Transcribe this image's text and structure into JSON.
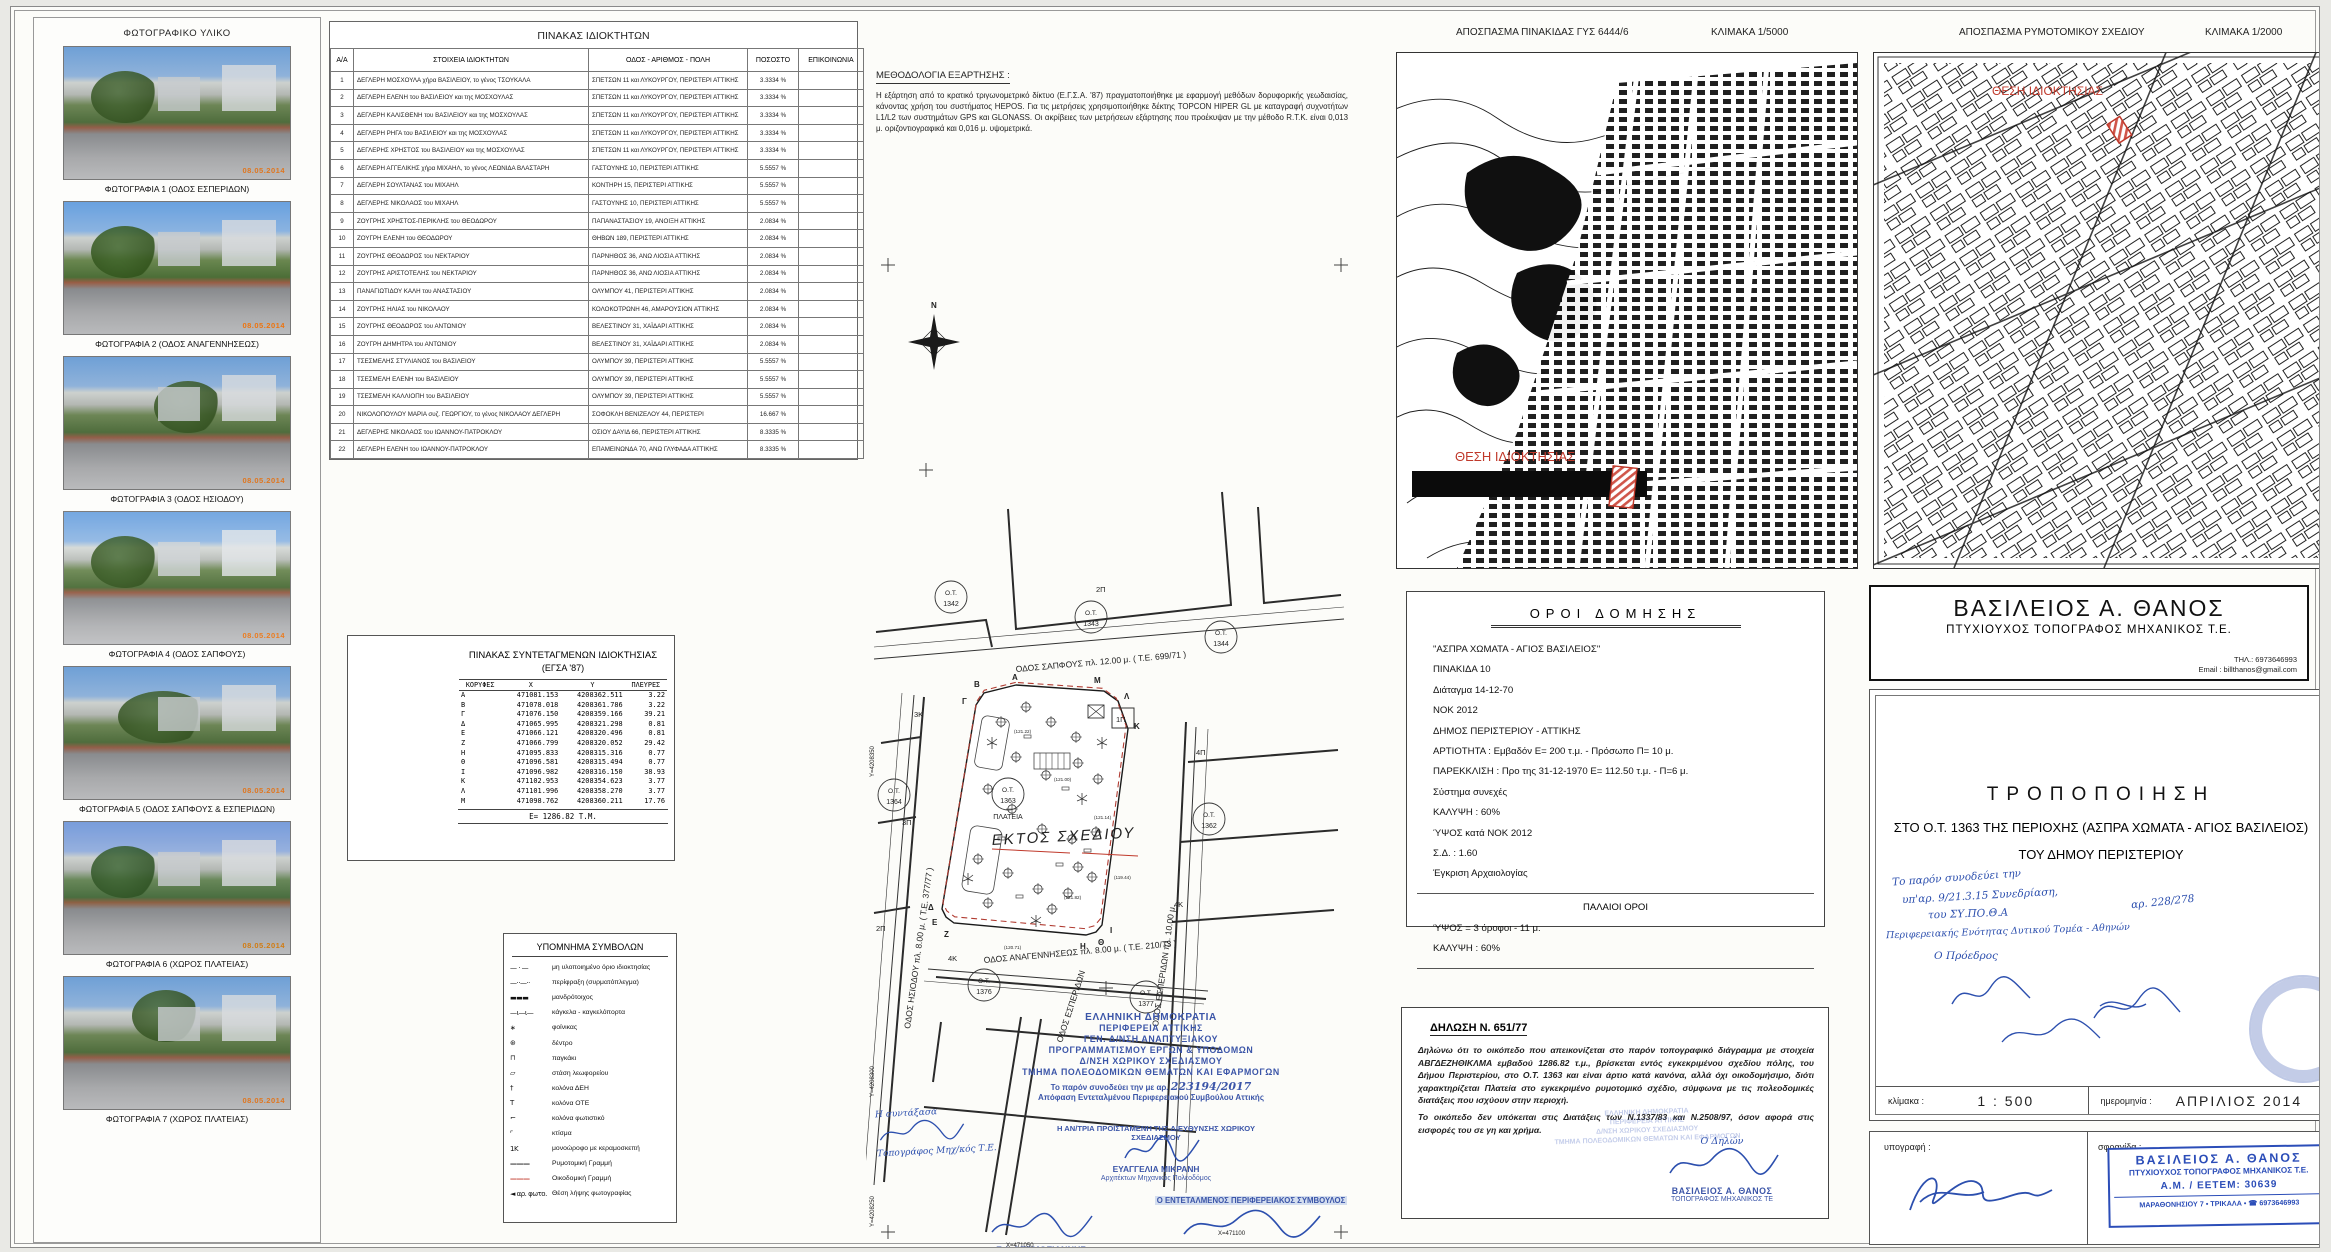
{
  "photos": {
    "title": "ΦΩΤΟΓΡΑΦΙΚΟ ΥΛΙΚΟ",
    "items": [
      {
        "caption": "ΦΩΤΟΓΡΑΦΙΑ 1 (ΟΔΟΣ ΕΣΠΕΡΙΔΩΝ)",
        "date": "08.05.2014"
      },
      {
        "caption": "ΦΩΤΟΓΡΑΦΙΑ 2 (ΟΔΟΣ ΑΝΑΓΕΝΝΗΣΕΩΣ)",
        "date": "08.05.2014"
      },
      {
        "caption": "ΦΩΤΟΓΡΑΦΙΑ 3 (ΟΔΟΣ ΗΣΙΟΔΟΥ)",
        "date": "08.05.2014"
      },
      {
        "caption": "ΦΩΤΟΓΡΑΦΙΑ 4 (ΟΔΟΣ ΣΑΠΦΟΥΣ)",
        "date": "08.05.2014"
      },
      {
        "caption": "ΦΩΤΟΓΡΑΦΙΑ 5 (ΟΔΟΣ ΣΑΠΦΟΥΣ & ΕΣΠΕΡΙΔΩΝ)",
        "date": "08.05.2014"
      },
      {
        "caption": "ΦΩΤΟΓΡΑΦΙΑ 6 (ΧΩΡΟΣ ΠΛΑΤΕΙΑΣ)",
        "date": "08.05.2014"
      },
      {
        "caption": "ΦΩΤΟΓΡΑΦΙΑ 7 (ΧΩΡΟΣ ΠΛΑΤΕΙΑΣ)",
        "date": "08.05.2014"
      }
    ]
  },
  "owners_table": {
    "title": "ΠΙΝΑΚΑΣ ΙΔΙΟΚΤΗΤΩΝ",
    "columns": [
      "Α/Α",
      "ΣΤΟΙΧΕΙΑ ΙΔΙΟΚΤΗΤΩΝ",
      "ΟΔΟΣ - ΑΡΙΘΜΟΣ - ΠΟΛΗ",
      "ΠΟΣΟΣΤΟ",
      "ΕΠΙΚΟΙΝΩΝΙΑ"
    ],
    "rows": [
      {
        "n": "1",
        "name": "ΔΕΓΛΕΡΗ ΜΟΣΧΟΥΛΑ χήρα ΒΑΣΙΛΕΙΟΥ, το γένος ΤΣΟΥΚΑΛΑ",
        "addr": "ΣΠΕΤΣΩΝ 11 και ΛΥΚΟΥΡΓΟΥ, ΠΕΡΙΣΤΕΡΙ ΑΤΤΙΚΗΣ",
        "pct": "3.3334 %",
        "contact": ""
      },
      {
        "n": "2",
        "name": "ΔΕΓΛΕΡΗ ΕΛΕΝΗ του ΒΑΣΙΛΕΙΟΥ και της ΜΟΣΧΟΥΛΑΣ",
        "addr": "ΣΠΕΤΣΩΝ 11 και ΛΥΚΟΥΡΓΟΥ, ΠΕΡΙΣΤΕΡΙ ΑΤΤΙΚΗΣ",
        "pct": "3.3334 %",
        "contact": ""
      },
      {
        "n": "3",
        "name": "ΔΕΓΛΕΡΗ ΚΑΛΙΣΘΕΝΗ του ΒΑΣΙΛΕΙΟΥ και της ΜΟΣΧΟΥΛΑΣ",
        "addr": "ΣΠΕΤΣΩΝ 11 και ΛΥΚΟΥΡΓΟΥ, ΠΕΡΙΣΤΕΡΙ ΑΤΤΙΚΗΣ",
        "pct": "3.3334 %",
        "contact": ""
      },
      {
        "n": "4",
        "name": "ΔΕΓΛΕΡΗ ΡΗΓΑ του ΒΑΣΙΛΕΙΟΥ και της ΜΟΣΧΟΥΛΑΣ",
        "addr": "ΣΠΕΤΣΩΝ 11 και ΛΥΚΟΥΡΓΟΥ, ΠΕΡΙΣΤΕΡΙ ΑΤΤΙΚΗΣ",
        "pct": "3.3334 %",
        "contact": ""
      },
      {
        "n": "5",
        "name": "ΔΕΓΛΕΡΗΣ ΧΡΗΣΤΟΣ του ΒΑΣΙΛΕΙΟΥ και της ΜΟΣΧΟΥΛΑΣ",
        "addr": "ΣΠΕΤΣΩΝ 11 και ΛΥΚΟΥΡΓΟΥ, ΠΕΡΙΣΤΕΡΙ ΑΤΤΙΚΗΣ",
        "pct": "3.3334 %",
        "contact": ""
      },
      {
        "n": "6",
        "name": "ΔΕΓΛΕΡΗ ΑΓΓΕΛΙΚΗΣ χήρα ΜΙΧΑΗΛ, το γένος ΛΕΩΝΙΔΑ ΒΛΑΣΤΑΡΗ",
        "addr": "ΓΑΣΤΟΥΝΗΣ 10, ΠΕΡΙΣΤΕΡΙ ΑΤΤΙΚΗΣ",
        "pct": "5.5557 %",
        "contact": ""
      },
      {
        "n": "7",
        "name": "ΔΕΓΛΕΡΗ ΣΟΥΛΤΑΝΑΣ του ΜΙΧΑΗΛ",
        "addr": "ΚΟΝΤΗΡΗ 15, ΠΕΡΙΣΤΕΡΙ ΑΤΤΙΚΗΣ",
        "pct": "5.5557 %",
        "contact": ""
      },
      {
        "n": "8",
        "name": "ΔΕΓΛΕΡΗΣ ΝΙΚΟΛΑΟΣ του ΜΙΧΑΗΛ",
        "addr": "ΓΑΣΤΟΥΝΗΣ 10, ΠΕΡΙΣΤΕΡΙ ΑΤΤΙΚΗΣ",
        "pct": "5.5557 %",
        "contact": ""
      },
      {
        "n": "9",
        "name": "ΖΟΥΓΡΗΣ ΧΡΗΣΤΟΣ-ΠΕΡΙΚΛΗΣ του ΘΕΟΔΩΡΟΥ",
        "addr": "ΠΑΠΑΝΑΣΤΑΣΙΟΥ 19, ΑΝΟΙΞΗ ΑΤΤΙΚΗΣ",
        "pct": "2.0834 %",
        "contact": ""
      },
      {
        "n": "10",
        "name": "ΖΟΥΓΡΗ ΕΛΕΝΗ του ΘΕΟΔΩΡΟΥ",
        "addr": "ΘΗΒΩΝ 189, ΠΕΡΙΣΤΕΡΙ ΑΤΤΙΚΗΣ",
        "pct": "2.0834 %",
        "contact": ""
      },
      {
        "n": "11",
        "name": "ΖΟΥΓΡΗΣ ΘΕΟΔΩΡΟΣ του ΝΕΚΤΑΡΙΟΥ",
        "addr": "ΠΑΡΝΗΘΟΣ 36, ΑΝΩ ΛΙΟΣΙΑ ΑΤΤΙΚΗΣ",
        "pct": "2.0834 %",
        "contact": ""
      },
      {
        "n": "12",
        "name": "ΖΟΥΓΡΗΣ ΑΡΙΣΤΟΤΕΛΗΣ του ΝΕΚΤΑΡΙΟΥ",
        "addr": "ΠΑΡΝΗΘΟΣ 36, ΑΝΩ ΛΙΟΣΙΑ ΑΤΤΙΚΗΣ",
        "pct": "2.0834 %",
        "contact": ""
      },
      {
        "n": "13",
        "name": "ΠΑΝΑΓΙΩΤΙΔΟΥ ΚΑΛΗ του ΑΝΑΣΤΑΣΙΟΥ",
        "addr": "ΟΛΥΜΠΟΥ 41, ΠΕΡΙΣΤΕΡΙ ΑΤΤΙΚΗΣ",
        "pct": "2.0834 %",
        "contact": ""
      },
      {
        "n": "14",
        "name": "ΖΟΥΓΡΗΣ ΗΛΙΑΣ του ΝΙΚΟΛΑΟΥ",
        "addr": "ΚΟΛΟΚΟΤΡΩΝΗ 46, ΑΜΑΡΟΥΣΙΟΝ ΑΤΤΙΚΗΣ",
        "pct": "2.0834 %",
        "contact": ""
      },
      {
        "n": "15",
        "name": "ΖΟΥΓΡΗΣ ΘΕΟΔΩΡΟΣ του ΑΝΤΩΝΙΟΥ",
        "addr": "ΒΕΛΕΣΤΙΝΟΥ 31, ΧΑΪΔΑΡΙ ΑΤΤΙΚΗΣ",
        "pct": "2.0834 %",
        "contact": ""
      },
      {
        "n": "16",
        "name": "ΖΟΥΓΡΗ ΔΗΜΗΤΡΑ του ΑΝΤΩΝΙΟΥ",
        "addr": "ΒΕΛΕΣΤΙΝΟΥ 31, ΧΑΪΔΑΡΙ ΑΤΤΙΚΗΣ",
        "pct": "2.0834 %",
        "contact": ""
      },
      {
        "n": "17",
        "name": "ΤΣΕΣΜΕΛΗΣ ΣΤΥΛΙΑΝΟΣ του ΒΑΣΙΛΕΙΟΥ",
        "addr": "ΟΛΥΜΠΟΥ 39, ΠΕΡΙΣΤΕΡΙ ΑΤΤΙΚΗΣ",
        "pct": "5.5557 %",
        "contact": ""
      },
      {
        "n": "18",
        "name": "ΤΣΕΣΜΕΛΗ ΕΛΕΝΗ του ΒΑΣΙΛΕΙΟΥ",
        "addr": "ΟΛΥΜΠΟΥ 39, ΠΕΡΙΣΤΕΡΙ ΑΤΤΙΚΗΣ",
        "pct": "5.5557 %",
        "contact": ""
      },
      {
        "n": "19",
        "name": "ΤΣΕΣΜΕΛΗ ΚΑΛΛΙΟΠΗ του ΒΑΣΙΛΕΙΟΥ",
        "addr": "ΟΛΥΜΠΟΥ 39, ΠΕΡΙΣΤΕΡΙ ΑΤΤΙΚΗΣ",
        "pct": "5.5557 %",
        "contact": ""
      },
      {
        "n": "20",
        "name": "ΝΙΚΟΛΟΠΟΥΛΟΥ ΜΑΡΙΑ συζ. ΓΕΩΡΓΙΟΥ, το γένος ΝΙΚΟΛΑΟΥ ΔΕΓΛΕΡΗ",
        "addr": "ΣΟΦΟΚΛΗ ΒΕΝΙΖΕΛΟΥ 44, ΠΕΡΙΣΤΕΡΙ",
        "pct": "16.667 %",
        "contact": ""
      },
      {
        "n": "21",
        "name": "ΔΕΓΛΕΡΗΣ ΝΙΚΟΛΑΟΣ του ΙΩΑΝΝΟΥ-ΠΑΤΡΟΚΛΟΥ",
        "addr": "ΟΣΙΟΥ ΔΑΥΙΔ 66, ΠΕΡΙΣΤΕΡΙ ΑΤΤΙΚΗΣ",
        "pct": "8.3335 %",
        "contact": ""
      },
      {
        "n": "22",
        "name": "ΔΕΓΛΕΡΗ ΕΛΕΝΗ του ΙΩΑΝΝΟΥ-ΠΑΤΡΟΚΛΟΥ",
        "addr": "ΕΠΑΜΕΙΝΩΝΔΑ 70, ΑΝΩ ΓΛΥΦΑΔΑ ΑΤΤΙΚΗΣ",
        "pct": "8.3335 %",
        "contact": ""
      }
    ]
  },
  "methodology": {
    "title": "ΜΕΘΟΔΟΛΟΓΙΑ ΕΞΑΡΤΗΣΗΣ :",
    "text": "Η εξάρτηση από το κρατικό τριγωνομετρικό δίκτυο (Ε.Γ.Σ.Α. '87) πραγματοποιήθηκε με εφαρμογή μεθόδων δορυφορικής γεωδαισίας, κάνοντας χρήση του συστήματος HEPOS. Για τις μετρήσεις χρησιμοποιήθηκε δέκτης TOPCON HIPER GL με καταγραφή συχνοτήτων L1/L2 των συστημάτων GPS και GLONASS. Οι ακρίβειες των μετρήσεων εξάρτησης που προέκυψαν με την μέθοδο R.T.K. είναι 0,013 μ. οριζοντιογραφικά και 0,016 μ. υψομετρικά."
  },
  "coords_table": {
    "title": "ΠΙΝΑΚΑΣ ΣΥΝΤΕΤΑΓΜΕΝΩΝ ΙΔΙΟΚΤΗΣΙΑΣ",
    "subtitle": "(ΕΓΣΑ '87)",
    "columns": [
      "ΚΟΡΥΦΕΣ",
      "Χ",
      "Υ",
      "ΠΛΕΥΡΕΣ"
    ],
    "rows": [
      {
        "v": "Α",
        "x": "471081.153",
        "y": "4208362.511",
        "s": "3.22"
      },
      {
        "v": "Β",
        "x": "471078.018",
        "y": "4208361.786",
        "s": "3.22"
      },
      {
        "v": "Γ",
        "x": "471076.150",
        "y": "4208359.166",
        "s": "39.21"
      },
      {
        "v": "Δ",
        "x": "471065.995",
        "y": "4208321.298",
        "s": "0.81"
      },
      {
        "v": "Ε",
        "x": "471066.121",
        "y": "4208320.496",
        "s": "0.81"
      },
      {
        "v": "Ζ",
        "x": "471066.799",
        "y": "4208320.052",
        "s": "29.42"
      },
      {
        "v": "Η",
        "x": "471095.833",
        "y": "4208315.316",
        "s": "0.77"
      },
      {
        "v": "Θ",
        "x": "471096.581",
        "y": "4208315.494",
        "s": "0.77"
      },
      {
        "v": "Ι",
        "x": "471096.982",
        "y": "4208316.150",
        "s": "38.93"
      },
      {
        "v": "Κ",
        "x": "471102.953",
        "y": "4208354.623",
        "s": "3.77"
      },
      {
        "v": "Λ",
        "x": "471101.996",
        "y": "4208358.270",
        "s": "3.77"
      },
      {
        "v": "Μ",
        "x": "471098.762",
        "y": "4208360.211",
        "s": "17.76"
      }
    ],
    "area": "Ε= 1286.82 Τ.Μ."
  },
  "legend": {
    "title": "ΥΠΟΜΝΗΜΑ ΣΥΜΒΟΛΩΝ",
    "items": [
      {
        "sym": "— · —",
        "label": "μη υλοποιημένο όριο ιδιοκτησίας"
      },
      {
        "sym": "—··—··",
        "label": "περίφραξη (συρματόπλεγμα)"
      },
      {
        "sym": "▬▬▬",
        "label": "μανδρότοιχος"
      },
      {
        "sym": "—ι—ι—",
        "label": "κάγκελα - καγκελόπορτα"
      },
      {
        "sym": "∗",
        "label": "φοίνικας"
      },
      {
        "sym": "⊛",
        "label": "δέντρο"
      },
      {
        "sym": "⊓",
        "label": "παγκάκι"
      },
      {
        "sym": "▱",
        "label": "στάση λεωφορείου"
      },
      {
        "sym": "†",
        "label": "κολόνα ΔΕΗ"
      },
      {
        "sym": "Τ",
        "label": "κολόνα ΟΤΕ"
      },
      {
        "sym": "⌐",
        "label": "κολόνα φωτιστικό"
      },
      {
        "sym": "⌜",
        "label": "κτίσμα"
      },
      {
        "sym": "1Κ",
        "label": "μονοώροφο με κεραμοσκεπή"
      },
      {
        "sym": "———",
        "label": "Ρυμοτομική Γραμμή"
      },
      {
        "sym": "———",
        "label": "Οικοδομική Γραμμή"
      },
      {
        "sym": "◄ αρ. φωτο.",
        "label": "Θέση λήψης φωτογραφίας"
      }
    ]
  },
  "maps": [
    {
      "title": "ΑΠΟΣΠΑΣΜΑ ΠΙΝΑΚΙΔΑΣ ΓΥΣ 6444/6",
      "scale": "ΚΛΙΜΑΚΑ 1/5000",
      "location_label": "ΘΕΣΗ ΙΔΙΟΚΤΗΣΙΑΣ"
    },
    {
      "title": "ΑΠΟΣΠΑΣΜΑ ΡΥΜΟΤΟΜΙΚΟΥ ΣΧΕΔΙΟΥ",
      "scale": "ΚΛΙΜΑΚΑ 1/2000",
      "location_label": "ΘΕΣΗ ΙΔΙΟΚΤΗΣΙΑΣ"
    }
  ],
  "site_plan": {
    "streets": [
      "ΟΔΟΣ ΣΑΠΦΟΥΣ  πλ. 12.00 μ. ( Τ.Ε. 699/71 )",
      "ΟΔΟΣ ΗΣΙΟΔΟΥ  πλ. 8.00 μ. ( Τ.Ε. 377/77 )",
      "ΟΔΟΣ ΕΣΠΕΡΙΔΩΝ  πλ. 10.00 μ.",
      "ΟΔΟΣ ΑΝΑΓΕΝΝΗΣΕΩΣ  πλ. 8.00 μ. ( Τ.Ε. 210/73 )",
      "ΟΔΟΣ ΕΣΠΕΡΙΔΩΝ"
    ],
    "ot_label": "Ο.Τ.",
    "blocks": [
      "1342",
      "1343",
      "1344",
      "1364",
      "1363",
      "1362",
      "1376",
      "1377"
    ],
    "plateia": "ΠΛΑΤΕΙΑ",
    "red_note": "ΕΚΤΟΣ ΣΧΕΔΙΟΥ",
    "vertices": [
      "Α",
      "Β",
      "Γ",
      "Δ",
      "Ε",
      "Ζ",
      "Η",
      "Θ",
      "Ι",
      "Κ",
      "Λ",
      "Μ"
    ],
    "bldg_labels": [
      "3Κ",
      "3Π",
      "2Π",
      "4Π",
      "4Κ",
      "1Π",
      "2Π",
      "4Κ"
    ],
    "spot_elevations": [
      "(121.22)",
      "(121.00)",
      "(121.14)",
      "(120.71)",
      "(121.82)",
      "(119.44)"
    ],
    "grid_labels": {
      "y1": "Υ=4208350",
      "y2": "Υ=4208300",
      "y3": "Υ=4208250",
      "x1": "Χ=471050",
      "x2": "Χ=471100"
    }
  },
  "approval": {
    "lines": [
      "ΕΛΛΗΝΙΚΗ ΔΗΜΟΚΡΑΤΙΑ",
      "ΠΕΡΙΦΕΡΕΙΑ ΑΤΤΙΚΗΣ",
      "ΓΕΝ. Δ/ΝΣΗ ΑΝΑΠΤΥΞΙΑΚΟΥ",
      "ΠΡΟΓΡΑΜΜΑΤΙΣΜΟΥ ΕΡΓΩΝ & ΥΠΟΔΟΜΩΝ",
      "Δ/ΝΣΗ ΧΩΡΙΚΟΥ ΣΧΕΔΙΑΣΜΟΥ",
      "ΤΜΗΜΑ ΠΟΛΕΟΔΟΜΙΚΩΝ ΘΕΜΑΤΩΝ ΚΑΙ ΕΦΑΡΜΟΓΩΝ"
    ],
    "accompanies": "Το παρόν συνοδεύει την με αρ.",
    "decision_no": "223194/2017",
    "accompanies2": "Απόφαση Εντεταλμένου Περιφερειακού Συμβούλου Αττικής",
    "author_note": "Η συντάξασα",
    "author_title": "Τοπογράφος Μηχ/κός Τ.Ε.",
    "director_role": "Η ΑΝ/ΤΡΙΑ ΠΡΟΪΣΤΑΜΕΝΗ ΤΗΣ ΔΙΕΥΘΥΝΣΗΣ ΧΩΡΙΚΟΥ ΣΧΕΔΙΑΣΜΟΥ",
    "director_name": "ΕΥΑΓΓΕΛΙΑ ΜΙΚΡΑΝΗ",
    "director_title": "Αρχιτέκτων Μηχανικός Πολεοδόμος",
    "surveyor_name": "Γ. Ι. ΘΕΡΜΟΓΙΑΝΝΗΣ",
    "surveyor_title": "Αγρονόμος - Τοπογράφος Μηχανικός",
    "councilor_role": "Ο ΕΝΤΕΤΑΛΜΕΝΟΣ ΠΕΡΙΦΕΡΕΙΑΚΟΣ ΣΥΜΒΟΥΛΟΣ",
    "councilor_name": "ΠΑΝΑΓΙΩΤΗΣ ΠΑΤΣΑΒΟΣ"
  },
  "building_terms": {
    "title": "ΟΡΟΙ ΔΟΜΗΣΗΣ",
    "lines": [
      "\"ΑΣΠΡΑ ΧΩΜΑΤΑ - ΑΓΙΟΣ ΒΑΣΙΛΕΙΟΣ\"",
      "ΠΙΝΑΚΙΔΑ 10",
      "Διάταγμα 14-12-70",
      "ΝΟΚ 2012",
      "ΔΗΜΟΣ ΠΕΡΙΣΤΕΡΙΟΥ - ΑΤΤΙΚΗΣ",
      "ΑΡΤΙΟΤΗΤΑ  :  Εμβαδόν  Ε= 200 τ.μ.  -  Πρόσωπο  Π= 10 μ.",
      "ΠΑΡΕΚΚΛΙΣΗ : Προ της 31-12-1970  Ε= 112.50 τ.μ.  -  Π=6 μ.",
      "Σύστημα συνεχές",
      "ΚΑΛΥΨΗ  : 60%",
      "ΎΨΟΣ κατά ΝΟΚ 2012",
      "Σ.Δ.  : 1.60",
      "Έγκριση Αρχαιολογίας"
    ],
    "old_title": "ΠΑΛΑΙΟΙ ΟΡΟΙ",
    "old_lines": [
      "ΎΨΟΣ =  3 όροφοι - 11 μ.",
      "ΚΑΛΥΨΗ  : 60%"
    ]
  },
  "declaration": {
    "title": "ΔΗΛΩΣΗ  Ν. 651/77",
    "p1": "Δηλώνω ότι το οικόπεδο που απεικονίζεται στο παρόν τοπογραφικό  διάγραμμα με στοιχεία ΑΒΓΔΕΖΗΘΙΚΛΜΑ εμβαδού 1286.82 τ.μ., βρίσκεται εντός εγκεκριμένου σχεδίου πόλης, του Δήμου Περιστερίου, στο Ο.Τ. 1363 και είναι άρτιο κατά κανόνα, αλλά όχι οικοδομήσιμο, διότι χαρακτηρίζεται Πλατεία στο εγκεκριμένο ρυμοτομικό σχέδιο, σύμφωνα με τις πολεοδομικές διατάξεις που ισχύουν στην περιοχή.",
    "p2": "Το οικόπεδο δεν υπόκειται στις Διατάξεις των Ν.1337/83 και Ν.2508/97, όσον αφορά στις εισφορές του σε γη και χρήμα.",
    "signer_label": "Ο Δηλών",
    "signer_name": "ΒΑΣΙΛΕΙΟΣ Α. ΘΑΝΟΣ",
    "signer_title": "ΤΟΠΟΓΡΑΦΟΣ ΜΗΧΑΝΙΚΟΣ ΤΕ"
  },
  "titleblock": {
    "name": "ΒΑΣΙΛΕΙΟΣ  Α. ΘΑΝΟΣ",
    "profession": "ΠΤΥΧΙΟΥΧΟΣ  ΤΟΠΟΓΡΑΦΟΣ  ΜΗΧΑΝΙΚΟΣ  Τ.Ε.",
    "phone": "ΤΗΛ.: 6973646993",
    "email": "Email : billthanos@gmail.com",
    "doc_title": "ΤΡΟΠΟΠΟΙΗΣΗ",
    "doc_sub1": "ΣΤΟ   Ο.Τ. 1363 ΤΗΣ ΠΕΡΙΟΧΗΣ (ΑΣΠΡΑ ΧΩΜΑΤΑ - ΑΓΙΟΣ ΒΑΣΙΛΕΙΟΣ)",
    "doc_sub2": "ΤΟΥ ΔΗΜΟΥ ΠΕΡΙΣΤΕΡΙΟΥ",
    "handwritten": [
      "Το παρόν συνοδεύει την",
      "υπ'αρ. 9/21.3.15 Συνεδρίαση,",
      "του ΣΥ.ΠΟ.Θ.Α",
      "Περιφερειακής Ενότητας Δυτικού Τομέα - Αθηνών",
      "Ο Πρόεδρος",
      "αρ. 228/278"
    ],
    "scale_label": "κλίμακα :",
    "scale_value": "1 : 500",
    "date_label": "ημερομηνία :",
    "date_value": "ΑΠΡΙΛΙΟΣ 2014",
    "signature_label": "υπογραφή :",
    "stamp_label": "σφραγίδα :",
    "stamp": {
      "l1": "ΒΑΣΙΛΕΙΟΣ Α. ΘΑΝΟΣ",
      "l2": "ΠΤΥΧΙΟΥΧΟΣ ΤΟΠΟΓΡΑΦΟΣ ΜΗΧΑΝΙΚΟΣ Τ.Ε.",
      "l3": "Α.Μ. / ΕΕΤΕΜ: 30639",
      "l4": "ΜΑΡΑΘΟΝΗΣΙΟΥ 7 • ΤΡΙΚΑΛΑ • ☎ 6973646993"
    }
  },
  "colors": {
    "stamp_blue": "#2b4db8",
    "red": "#c0392b",
    "date_orange": "#e0761e"
  }
}
